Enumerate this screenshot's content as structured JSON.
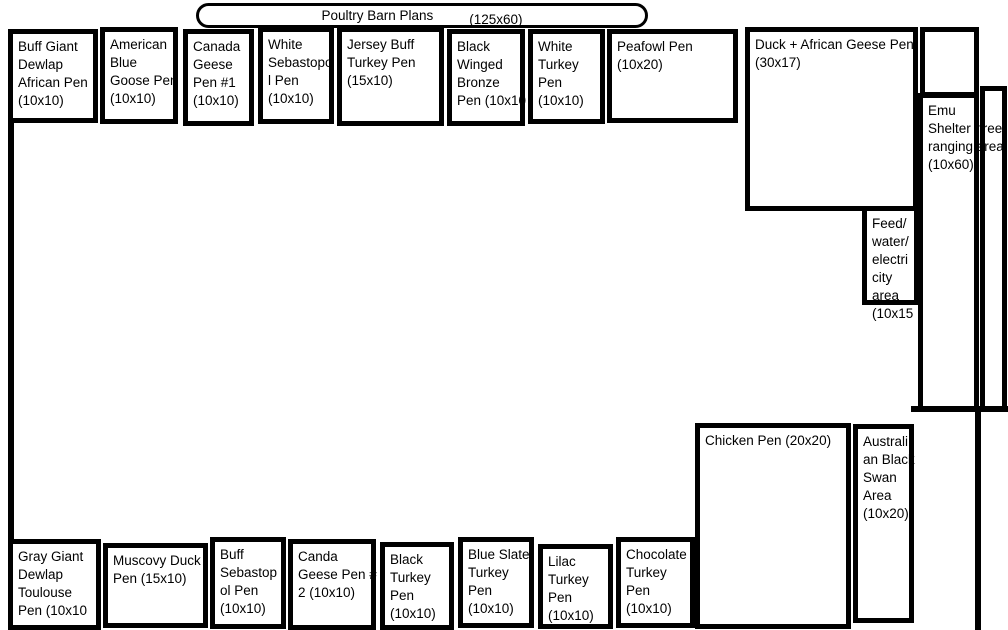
{
  "title": {
    "label": "Poultry Barn Plans",
    "dims": "(125x60)"
  },
  "colors": {
    "line": "#000000",
    "background": "#ffffff",
    "text": "#000000"
  },
  "pens": [
    {
      "name": "buff-giant-dewlap-african-pen",
      "label": "Buff Giant\nDewlap\nAfrican Pen\n(10x10)",
      "x": 8,
      "y": 29,
      "w": 90,
      "h": 94
    },
    {
      "name": "american-blue-goose-pen",
      "label": "American\nBlue\nGoose Pen\n(10x10)",
      "x": 100,
      "y": 27,
      "w": 78,
      "h": 97
    },
    {
      "name": "canada-geese-pen-1",
      "label": "Canada\nGeese\nPen #1\n(10x10)",
      "x": 183,
      "y": 29,
      "w": 71,
      "h": 97
    },
    {
      "name": "white-sebastopol-pen",
      "label": "White\nSebastopo\nl Pen\n(10x10)",
      "x": 258,
      "y": 27,
      "w": 76,
      "h": 97
    },
    {
      "name": "jersey-buff-turkey-pen",
      "label": "Jersey Buff\nTurkey Pen\n(15x10)",
      "x": 337,
      "y": 27,
      "w": 107,
      "h": 99
    },
    {
      "name": "black-winged-bronze-pen",
      "label": "Black\nWinged\nBronze\nPen (10x10",
      "x": 447,
      "y": 29,
      "w": 78,
      "h": 97
    },
    {
      "name": "white-turkey-pen",
      "label": "White\nTurkey\nPen\n(10x10)",
      "x": 528,
      "y": 29,
      "w": 77,
      "h": 95
    },
    {
      "name": "peafowl-pen",
      "label": "Peafowl Pen\n(10x20)",
      "x": 607,
      "y": 29,
      "w": 131,
      "h": 94
    },
    {
      "name": "duck-african-geese-pen",
      "label": "Duck + African Geese Pen\n(30x17)",
      "x": 745,
      "y": 27,
      "w": 173,
      "h": 184
    },
    {
      "name": "emu-shelter-free-ranging-area",
      "label": "Emu\nShelter (free\nranging area\n(10x60)",
      "x": 918,
      "y": 93,
      "w": 61,
      "h": 318
    },
    {
      "name": "feed-water-electricity-area",
      "label": "Feed/\nwater/\nelectri\ncity\narea\n(10x15",
      "x": 862,
      "y": 206,
      "w": 57,
      "h": 99
    },
    {
      "name": "chicken-pen",
      "label": "Chicken Pen (20x20)",
      "x": 695,
      "y": 423,
      "w": 156,
      "h": 206
    },
    {
      "name": "australian-black-swan-area",
      "label": "Australi\nan Black\nSwan\nArea\n(10x20)",
      "x": 853,
      "y": 424,
      "w": 61,
      "h": 199
    },
    {
      "name": "gray-giant-dewlap-toulouse-pen",
      "label": "Gray Giant\nDewlap\nToulouse\nPen (10x10",
      "x": 8,
      "y": 539,
      "w": 93,
      "h": 91
    },
    {
      "name": "muscovy-duck-pen",
      "label": "Muscovy Duck\nPen (15x10)",
      "x": 103,
      "y": 543,
      "w": 105,
      "h": 85
    },
    {
      "name": "buff-sebastopol-pen",
      "label": "Buff\nSebastop\nol Pen\n(10x10)",
      "x": 210,
      "y": 537,
      "w": 76,
      "h": 92
    },
    {
      "name": "canda-geese-pen-2",
      "label": "Canda\nGeese Pen #\n2 (10x10)",
      "x": 288,
      "y": 539,
      "w": 88,
      "h": 91
    },
    {
      "name": "black-turkey-pen",
      "label": "Black\nTurkey\nPen\n(10x10)",
      "x": 380,
      "y": 542,
      "w": 74,
      "h": 88
    },
    {
      "name": "blue-slate-turkey-pen",
      "label": "Blue Slate\nTurkey\nPen\n(10x10)",
      "x": 458,
      "y": 537,
      "w": 76,
      "h": 91
    },
    {
      "name": "lilac-turkey-pen",
      "label": "Lilac\nTurkey\nPen\n(10x10)",
      "x": 538,
      "y": 544,
      "w": 75,
      "h": 85
    },
    {
      "name": "chocolate-turkey-pen",
      "label": "Chocolate\nTurkey\nPen\n(10x10)",
      "x": 616,
      "y": 537,
      "w": 79,
      "h": 91
    }
  ],
  "shapes": [
    {
      "name": "unlabeled-box-top-right",
      "type": "box",
      "x": 920,
      "y": 27,
      "w": 59,
      "h": 70
    },
    {
      "name": "free-range-strip",
      "type": "box",
      "x": 980,
      "y": 86,
      "w": 27,
      "h": 325
    },
    {
      "name": "left-boundary-line",
      "type": "line",
      "x": 8,
      "y": 29,
      "w": 6,
      "h": 601
    },
    {
      "name": "right-boundary-line",
      "type": "line",
      "x": 975,
      "y": 409,
      "w": 6,
      "h": 221
    },
    {
      "name": "emu-area-bottom-line",
      "type": "line",
      "x": 911,
      "y": 406,
      "w": 97,
      "h": 6
    }
  ]
}
